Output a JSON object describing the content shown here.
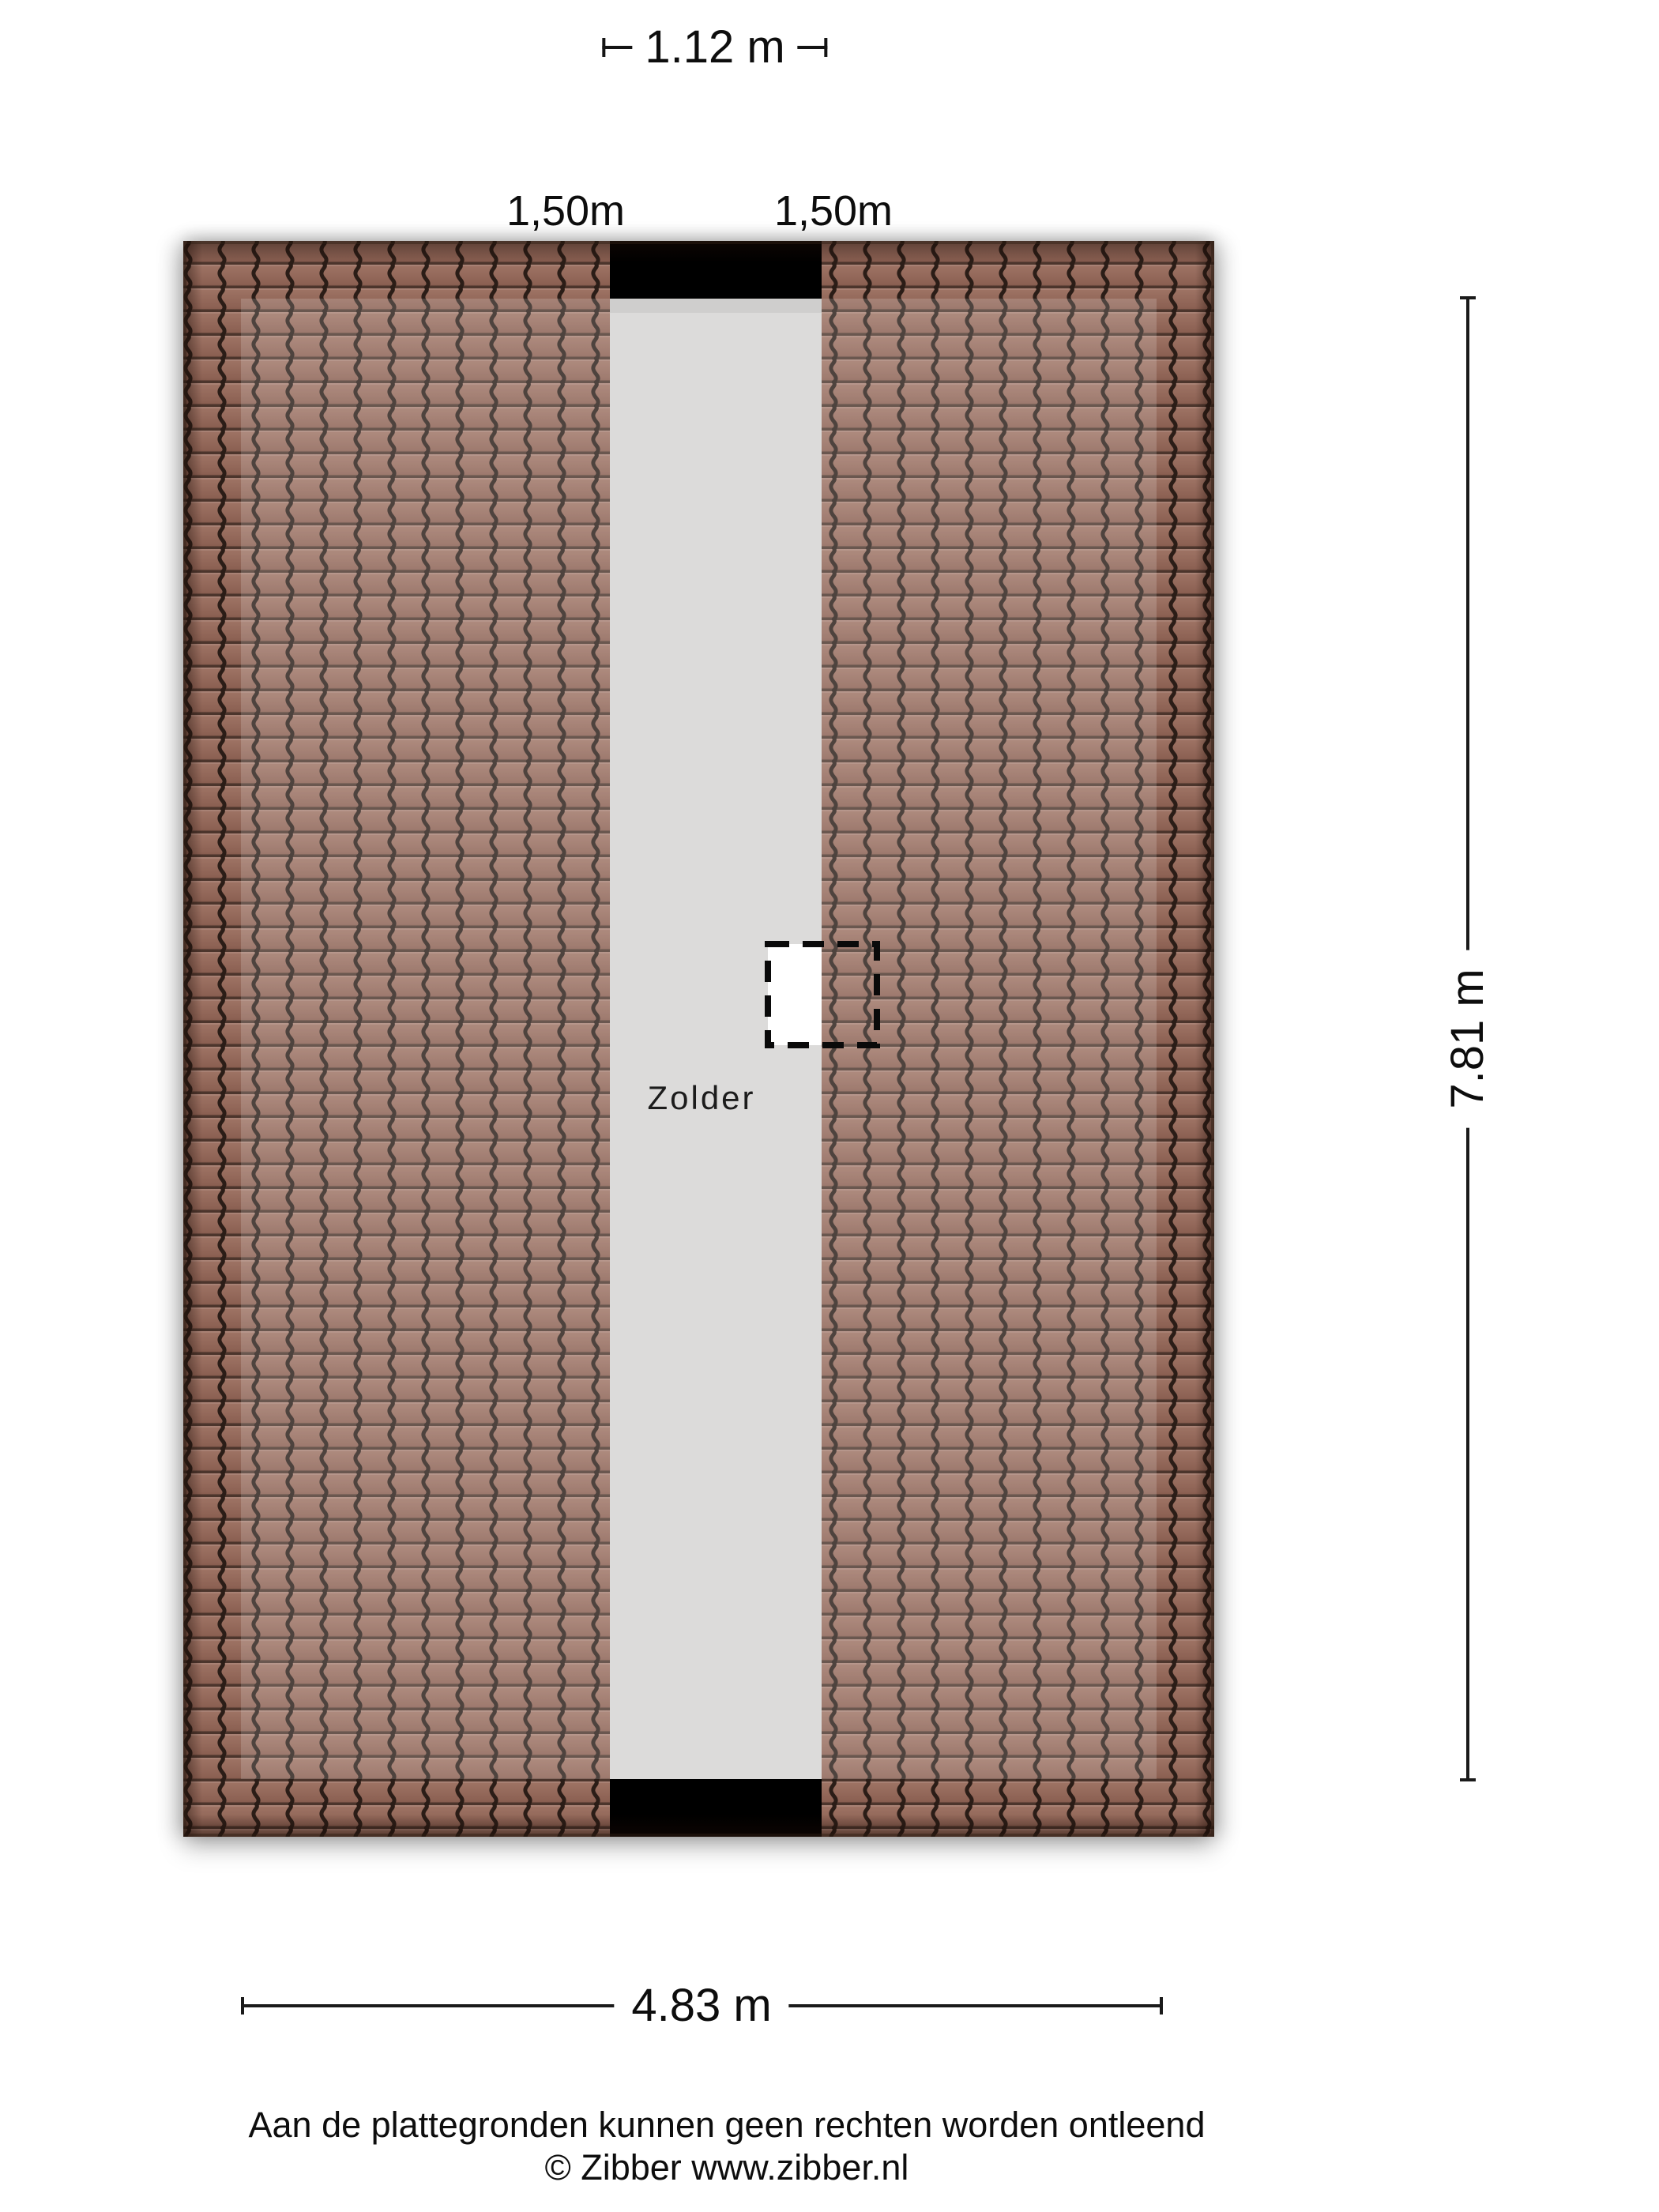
{
  "room": {
    "label": "Zolder"
  },
  "dimensions": {
    "top": {
      "label": "1.12 m"
    },
    "roof_left": {
      "label": "1,50m"
    },
    "roof_right": {
      "label": "1,50m"
    },
    "height": {
      "label": "7.81 m"
    },
    "width": {
      "label": "4.83 m"
    }
  },
  "footer": {
    "disclaimer": "Aan de plattegronden kunnen geen rechten worden ontleend",
    "copyright": "© Zibber www.zibber.nl"
  },
  "colors": {
    "roof_tile_base": "#8f6356",
    "roof_tile_row_dark": "#7e5448",
    "roof_tile_line": "#2b1d17",
    "attic_floor_gray": "#dcdbda",
    "wall_black": "#000000",
    "dimension_text": "#0d0d0d",
    "background": "#ffffff"
  }
}
